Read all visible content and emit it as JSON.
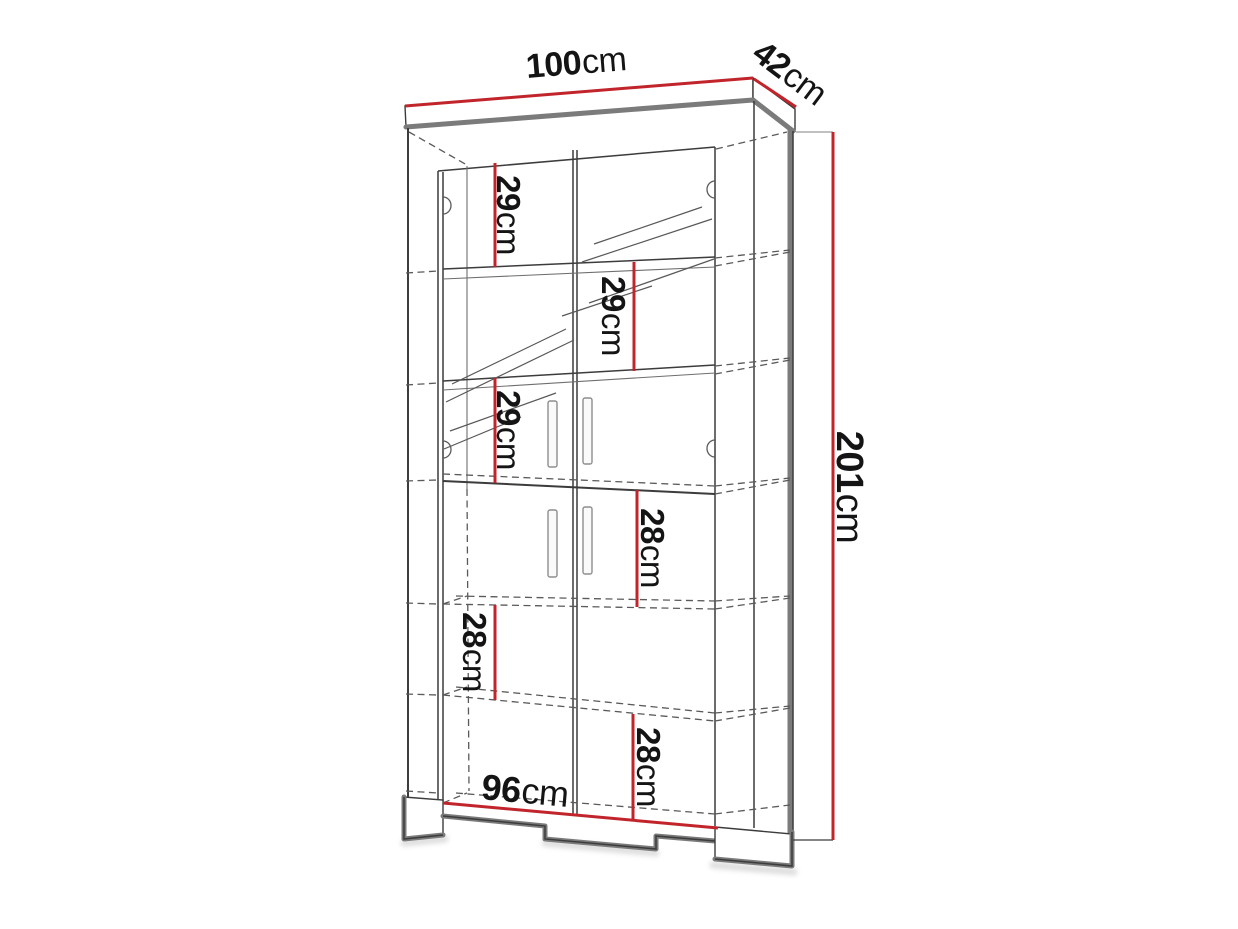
{
  "diagram": {
    "subject": "tall display cabinet dimension drawing",
    "accent_color": "#c1252b",
    "outline_color": "#3c3c3c",
    "dims": {
      "width": {
        "value": "100",
        "unit": "cm"
      },
      "depth": {
        "value": "42",
        "unit": "cm"
      },
      "height": {
        "value": "201",
        "unit": "cm"
      },
      "base_width": {
        "value": "96",
        "unit": "cm"
      },
      "shelves": [
        {
          "value": "29",
          "unit": "cm"
        },
        {
          "value": "29",
          "unit": "cm"
        },
        {
          "value": "29",
          "unit": "cm"
        },
        {
          "value": "28",
          "unit": "cm"
        },
        {
          "value": "28",
          "unit": "cm"
        },
        {
          "value": "28",
          "unit": "cm"
        }
      ]
    }
  }
}
